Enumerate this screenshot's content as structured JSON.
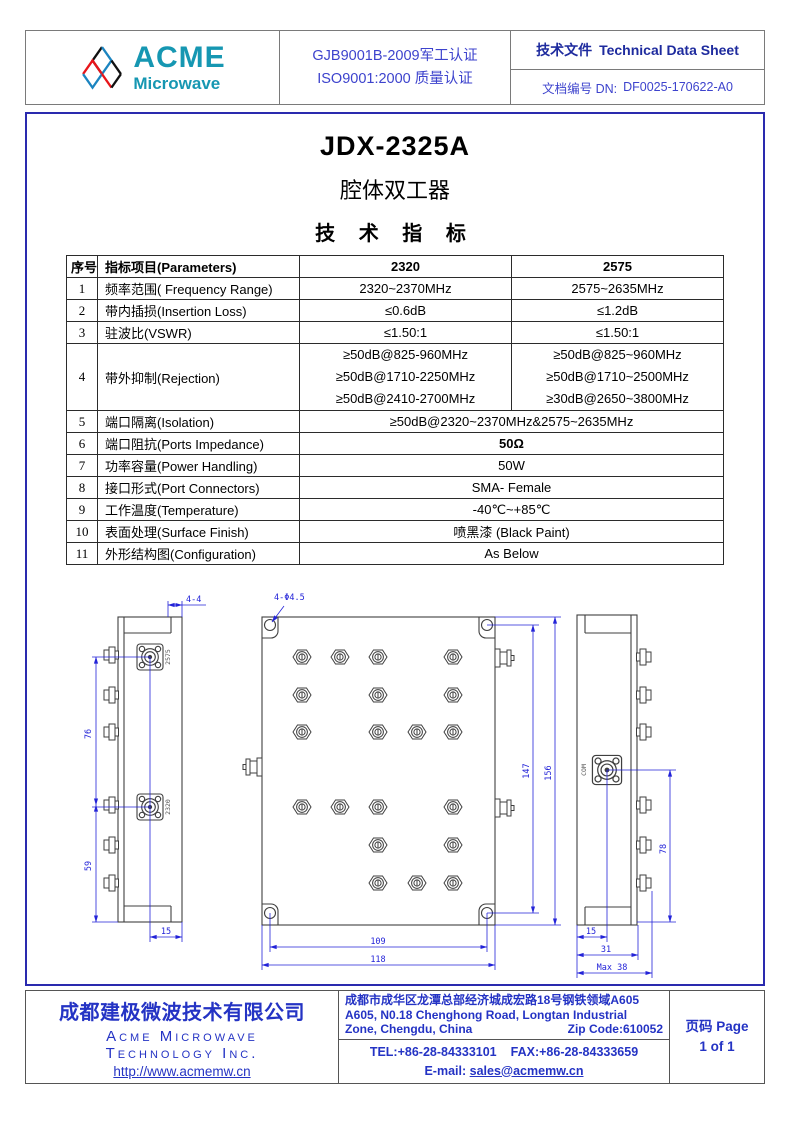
{
  "colors": {
    "accent_border": "#2a2aae",
    "header_border": "#7a7a7a",
    "blue_text": "#2433c4",
    "navy_text": "#1e2b9e",
    "logo_teal": "#1697b2",
    "logo_red": "#e8151a",
    "dim_blue": "#2323d8"
  },
  "header": {
    "logo": {
      "brand": "ACME",
      "sub": "Microwave"
    },
    "cert_line1": "GJB9001B-2009军工认证",
    "cert_line2": "ISO9001:2000 质量认证",
    "doc_type_cn": "技术文件",
    "doc_type_en": "Technical Data Sheet",
    "doc_no_label": "文档编号 DN:",
    "doc_no": "DF0025-170622-A0"
  },
  "title": {
    "model": "JDX-2325A",
    "product_cn": "腔体双工器",
    "section_cn": "技 术 指 标"
  },
  "spec_table": {
    "headers": [
      "序号",
      "指标项目(Parameters)",
      "2320",
      "2575"
    ],
    "rows": [
      {
        "no": "1",
        "param": "频率范围( Frequency Range)",
        "v1": "2320~2370MHz",
        "v2": "2575~2635MHz"
      },
      {
        "no": "2",
        "param": "带内插损(Insertion Loss)",
        "v1": "≤0.6dB",
        "v2": "≤1.2dB"
      },
      {
        "no": "3",
        "param": "驻波比(VSWR)",
        "v1": "≤1.50:1",
        "v2": "≤1.50:1"
      },
      {
        "no": "4",
        "param": "带外抑制(Rejection)",
        "v1_lines": [
          "≥50dB@825-960MHz",
          "≥50dB@1710-2250MHz",
          "≥50dB@2410-2700MHz"
        ],
        "v2_lines": [
          "≥50dB@825~960MHz",
          "≥50dB@1710~2500MHz",
          "≥30dB@2650~3800MHz"
        ]
      },
      {
        "no": "5",
        "param": "端口隔离(Isolation)",
        "span": "≥50dB@2320~2370MHz&2575~2635MHz"
      },
      {
        "no": "6",
        "param": "端口阻抗(Ports Impedance)",
        "span": "50Ω"
      },
      {
        "no": "7",
        "param": "功率容量(Power Handling)",
        "span": "50W"
      },
      {
        "no": "8",
        "param": "接口形式(Port Connectors)",
        "span": "SMA- Female"
      },
      {
        "no": "9",
        "param": "工作温度(Temperature)",
        "span": "-40℃~+85℃"
      },
      {
        "no": "10",
        "param": "表面处理(Surface Finish)",
        "span": "喷黑漆  (Black Paint)"
      },
      {
        "no": "11",
        "param": "外形结构图(Configuration)",
        "span": "As Below"
      }
    ]
  },
  "drawing": {
    "hole_callout": "4-Φ4.5",
    "port_top": "2575",
    "port_bottom": "2320",
    "port_com": "COM",
    "dims": {
      "left_top": "4-4",
      "left_h1": "76",
      "left_h2": "59",
      "left_w": "15",
      "main_h1": "147",
      "main_h2": "156",
      "main_w1": "109",
      "main_w2": "118",
      "right_h": "78",
      "right_w1": "15",
      "right_w2": "31",
      "right_w3": "Max 38"
    }
  },
  "footer": {
    "company_cn": "成都建极微波技术有限公司",
    "company_en1": "Acme Microwave",
    "company_en2": "Technology Inc.",
    "url": "http://www.acmemw.cn",
    "addr_cn": "成都市成华区龙潭总部经济城成宏路18号钢铁领域A605",
    "addr_en1": "A605, N0.18 Chenghong Road, Longtan Industrial",
    "addr_en2": "Zone, Chengdu, China",
    "zip": "Zip Code:610052",
    "tel": "TEL:+86-28-84333101",
    "fax": "FAX:+86-28-84333659",
    "email_label": "E-mail:",
    "email": "sales@acmemw.cn",
    "page_label": "页码 Page",
    "page_value": "1 of 1"
  }
}
